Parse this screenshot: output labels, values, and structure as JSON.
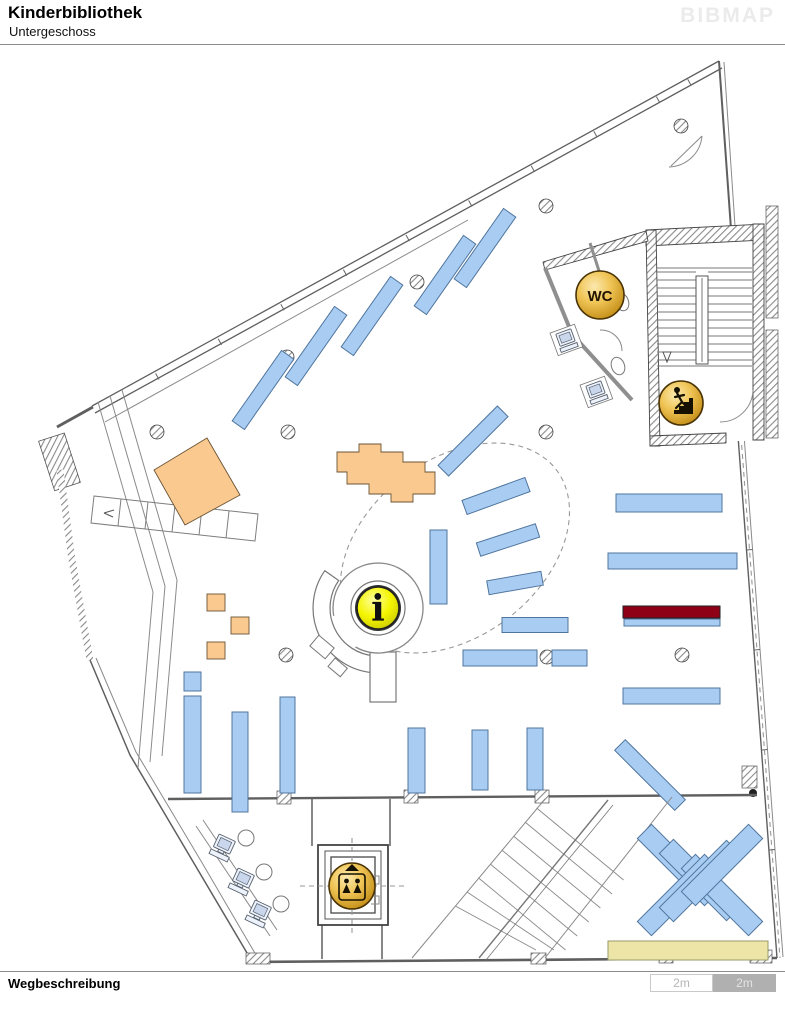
{
  "header": {
    "title": "Kinderbibliothek",
    "subtitle": "Untergeschoss",
    "logo": "BIBMAP"
  },
  "footer": {
    "label": "Wegbeschreibung",
    "scale_left": "2m",
    "scale_right": "2m"
  },
  "map": {
    "floor": "Untergeschoss",
    "icons": {
      "wc_label": "WC",
      "info_label": "i",
      "stairs": "stairs-person-icon",
      "elevator": "elevator-icon"
    }
  },
  "colors": {
    "shelf": "#a9cdf2",
    "shelf_stroke": "#4f759e",
    "furniture": "#f9c98f",
    "highlight": "#8e0016",
    "bench": "#ece5a7",
    "wall": "#5f5f5f",
    "gold1": "#f8d978",
    "gold2": "#cf9417",
    "info1": "#ffff6e",
    "info2": "#dcdc00",
    "scale_bg": "#b0b0b0"
  }
}
